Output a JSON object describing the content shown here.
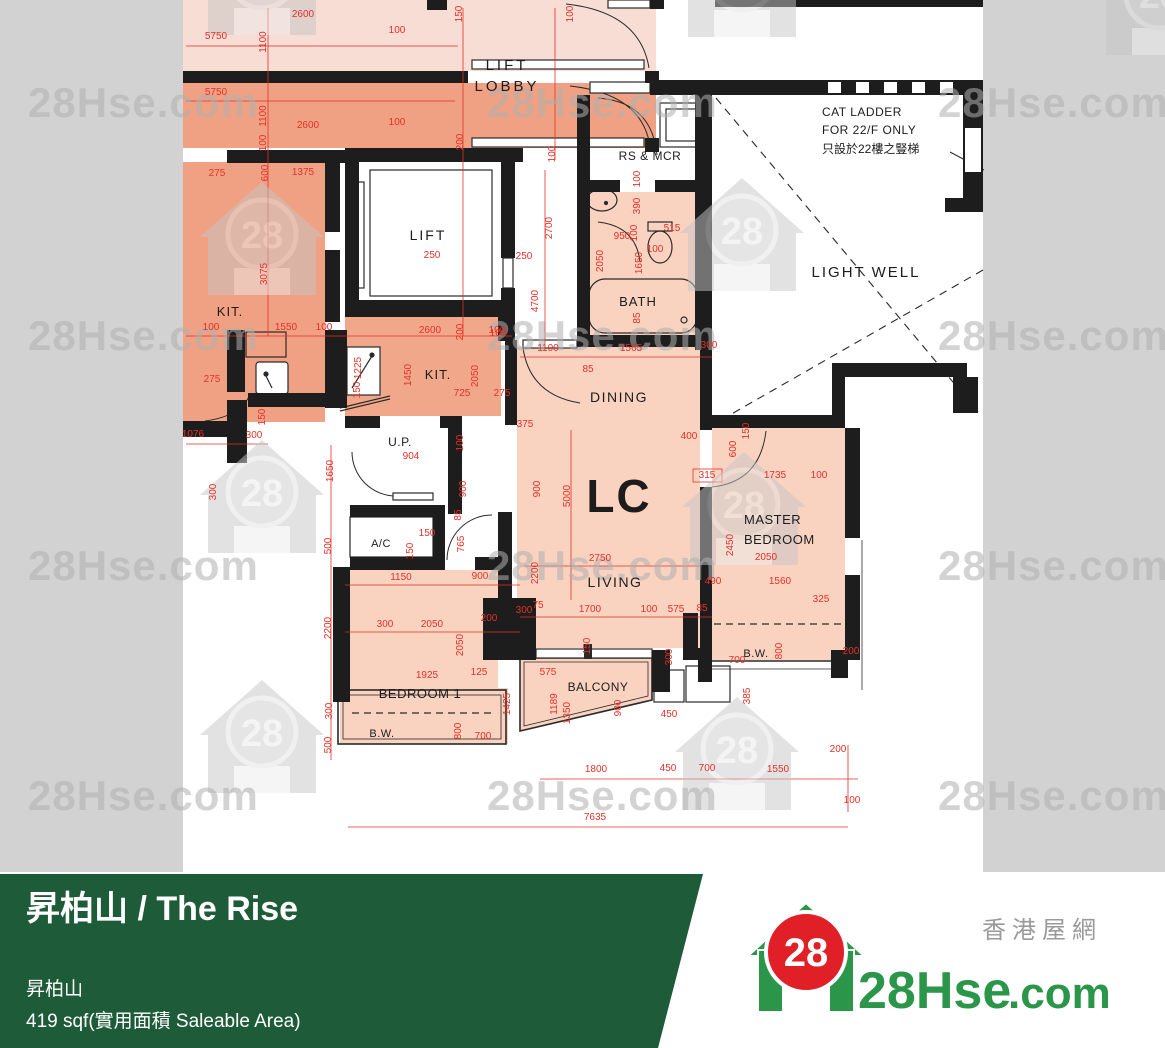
{
  "colors": {
    "page_bg": "#d2d2d2",
    "plan_bg": "#ffffff",
    "wall": "#1d1d1d",
    "dim_red": "#e23128",
    "unit_pale": "#f8ddd4",
    "unit_dark": "#f0a183",
    "kitchen": "#f1a78a",
    "unit_main": "#f9d2c0",
    "banner_green": "#1e5b38",
    "logo_green": "#2b9549",
    "logo_red": "#e01f26"
  },
  "plan": {
    "room_labels": [
      {
        "t": "LIFT",
        "x": 507,
        "y": 70,
        "s": 15,
        "a": "m",
        "ls": 3
      },
      {
        "t": "LOBBY",
        "x": 507,
        "y": 91,
        "s": 15,
        "a": "m",
        "ls": 3
      },
      {
        "t": "RS & MCR",
        "x": 650,
        "y": 160,
        "s": 12,
        "a": "m",
        "ls": 0.5
      },
      {
        "t": "CAT LADDER",
        "x": 822,
        "y": 116,
        "s": 12,
        "a": "s",
        "ls": 0.5
      },
      {
        "t": "FOR 22/F ONLY",
        "x": 822,
        "y": 134,
        "s": 12,
        "a": "s",
        "ls": 0.5
      },
      {
        "t": "只設於22樓之豎梯",
        "x": 822,
        "y": 153,
        "s": 12,
        "a": "s",
        "ls": 0
      },
      {
        "t": "LIGHT WELL",
        "x": 866,
        "y": 277,
        "s": 15,
        "a": "m",
        "ls": 2
      },
      {
        "t": "LIFT",
        "x": 428,
        "y": 240,
        "s": 14,
        "a": "m",
        "ls": 2
      },
      {
        "t": "KIT.",
        "x": 230,
        "y": 316,
        "s": 13,
        "a": "m",
        "ls": 1
      },
      {
        "t": "KIT.",
        "x": 438,
        "y": 379,
        "s": 13,
        "a": "m",
        "ls": 1
      },
      {
        "t": "BATH",
        "x": 638,
        "y": 306,
        "s": 13,
        "a": "m",
        "ls": 1
      },
      {
        "t": "DINING",
        "x": 619,
        "y": 402,
        "s": 14,
        "a": "m",
        "ls": 1.5
      },
      {
        "t": "LC",
        "x": 619,
        "y": 512,
        "s": 46,
        "a": "m",
        "ls": 2,
        "b": 1
      },
      {
        "t": "U.P.",
        "x": 400,
        "y": 446,
        "s": 12,
        "a": "m",
        "ls": 0.5
      },
      {
        "t": "A/C",
        "x": 381,
        "y": 547,
        "s": 11,
        "a": "m",
        "ls": 0.5
      },
      {
        "t": "MASTER",
        "x": 744,
        "y": 524,
        "s": 13,
        "a": "s",
        "ls": 0.5
      },
      {
        "t": "BEDROOM",
        "x": 744,
        "y": 544,
        "s": 13,
        "a": "s",
        "ls": 0.5
      },
      {
        "t": "LIVING",
        "x": 615,
        "y": 587,
        "s": 14,
        "a": "m",
        "ls": 1.5
      },
      {
        "t": "BEDROOM 1",
        "x": 420,
        "y": 698,
        "s": 13,
        "a": "m",
        "ls": 0.5
      },
      {
        "t": "BALCONY",
        "x": 598,
        "y": 691,
        "s": 12,
        "a": "m",
        "ls": 0.5
      },
      {
        "t": "B.W.",
        "x": 382,
        "y": 737,
        "s": 11,
        "a": "m",
        "ls": 0.5
      },
      {
        "t": "B.W.",
        "x": 756,
        "y": 657,
        "s": 11,
        "a": "m",
        "ls": 0.5
      }
    ],
    "dims": [
      [
        "2600",
        303,
        17,
        0
      ],
      [
        "100",
        397,
        33,
        0
      ],
      [
        "150",
        462,
        14,
        1
      ],
      [
        "100",
        573,
        14,
        1
      ],
      [
        "5750",
        216,
        39,
        0
      ],
      [
        "1100",
        266,
        42,
        1
      ],
      [
        "5750",
        216,
        95,
        0
      ],
      [
        "1100",
        266,
        116,
        1
      ],
      [
        "2600",
        308,
        128,
        0
      ],
      [
        "100",
        397,
        125,
        0
      ],
      [
        "100",
        266,
        143,
        1
      ],
      [
        "200",
        463,
        142,
        1
      ],
      [
        "100",
        555,
        154,
        1
      ],
      [
        "275",
        217,
        176,
        0
      ],
      [
        "600",
        268,
        173,
        1
      ],
      [
        "1375",
        303,
        175,
        0
      ],
      [
        "250",
        432,
        258,
        0
      ],
      [
        "250",
        524,
        259,
        0
      ],
      [
        "3075",
        267,
        274,
        1
      ],
      [
        "2700",
        552,
        228,
        1
      ],
      [
        "100",
        640,
        179,
        1
      ],
      [
        "390",
        640,
        206,
        1
      ],
      [
        "100",
        637,
        233,
        1
      ],
      [
        "515",
        672,
        231,
        0
      ],
      [
        "950",
        622,
        239,
        0
      ],
      [
        "100",
        655,
        252,
        0
      ],
      [
        "2050",
        603,
        261,
        1
      ],
      [
        "1650",
        642,
        263,
        1
      ],
      [
        "85",
        640,
        318,
        1
      ],
      [
        "100",
        211,
        330,
        0
      ],
      [
        "1550",
        286,
        330,
        0
      ],
      [
        "100",
        324,
        330,
        0
      ],
      [
        "2600",
        430,
        333,
        0
      ],
      [
        "200",
        463,
        332,
        1
      ],
      [
        "100",
        497,
        333,
        0
      ],
      [
        "275",
        212,
        382,
        0
      ],
      [
        "1225",
        361,
        368,
        1
      ],
      [
        "150",
        360,
        390,
        1
      ],
      [
        "150",
        265,
        417,
        1
      ],
      [
        "1076",
        193,
        437,
        0
      ],
      [
        "300",
        254,
        438,
        0
      ],
      [
        "300",
        216,
        492,
        1
      ],
      [
        "4700",
        538,
        301,
        1
      ],
      [
        "100",
        498,
        336,
        0
      ],
      [
        "1100",
        548,
        351,
        0
      ],
      [
        "1565",
        631,
        351,
        0
      ],
      [
        "300",
        709,
        348,
        0
      ],
      [
        "85",
        588,
        372,
        0
      ],
      [
        "1450",
        411,
        375,
        1
      ],
      [
        "2050",
        478,
        376,
        1
      ],
      [
        "725",
        462,
        396,
        0
      ],
      [
        "275",
        502,
        396,
        0
      ],
      [
        "375",
        525,
        427,
        0
      ],
      [
        "100",
        463,
        443,
        1
      ],
      [
        "904",
        411,
        459,
        0
      ],
      [
        "400",
        689,
        439,
        0
      ],
      [
        "600",
        736,
        449,
        1
      ],
      [
        "150",
        749,
        431,
        1
      ],
      [
        "315",
        707,
        478,
        0
      ],
      [
        "1735",
        775,
        478,
        0
      ],
      [
        "100",
        819,
        478,
        0
      ],
      [
        "900",
        466,
        489,
        1
      ],
      [
        "900",
        540,
        489,
        1
      ],
      [
        "5000",
        570,
        496,
        1
      ],
      [
        "85",
        461,
        515,
        1
      ],
      [
        "765",
        464,
        544,
        1
      ],
      [
        "150",
        427,
        536,
        0
      ],
      [
        "150",
        413,
        551,
        1
      ],
      [
        "2750",
        600,
        561,
        0
      ],
      [
        "2200",
        538,
        573,
        1
      ],
      [
        "2450",
        733,
        545,
        1
      ],
      [
        "2050",
        766,
        560,
        0
      ],
      [
        "1150",
        401,
        580,
        0
      ],
      [
        "900",
        480,
        579,
        0
      ],
      [
        "490",
        713,
        584,
        0
      ],
      [
        "1560",
        780,
        584,
        0
      ],
      [
        "300",
        385,
        627,
        0
      ],
      [
        "2050",
        432,
        627,
        0
      ],
      [
        "200",
        489,
        621,
        0
      ],
      [
        "2050",
        463,
        645,
        1
      ],
      [
        "300",
        524,
        613,
        0
      ],
      [
        "75",
        538,
        608,
        0
      ],
      [
        "1700",
        590,
        612,
        0
      ],
      [
        "100",
        649,
        612,
        0
      ],
      [
        "575",
        676,
        612,
        0
      ],
      [
        "85",
        702,
        611,
        0
      ],
      [
        "325",
        821,
        602,
        0
      ],
      [
        "150",
        590,
        646,
        1
      ],
      [
        "300",
        672,
        657,
        1
      ],
      [
        "700",
        737,
        663,
        0
      ],
      [
        "800",
        782,
        651,
        1
      ],
      [
        "200",
        851,
        654,
        0
      ],
      [
        "1925",
        427,
        678,
        0
      ],
      [
        "125",
        479,
        675,
        0
      ],
      [
        "575",
        548,
        675,
        0
      ],
      [
        "1425",
        510,
        704,
        1
      ],
      [
        "1189",
        557,
        704,
        1
      ],
      [
        "1350",
        570,
        713,
        1
      ],
      [
        "900",
        621,
        708,
        1
      ],
      [
        "450",
        669,
        717,
        0
      ],
      [
        "385",
        750,
        696,
        1
      ],
      [
        "800",
        461,
        731,
        1
      ],
      [
        "700",
        483,
        739,
        0
      ],
      [
        "1650",
        333,
        471,
        1
      ],
      [
        "500",
        331,
        546,
        1
      ],
      [
        "2200",
        331,
        628,
        1
      ],
      [
        "300",
        332,
        711,
        1
      ],
      [
        "500",
        331,
        745,
        1
      ],
      [
        "1800",
        596,
        772,
        0
      ],
      [
        "450",
        668,
        771,
        0
      ],
      [
        "700",
        707,
        771,
        0
      ],
      [
        "1550",
        778,
        772,
        0
      ],
      [
        "200",
        838,
        752,
        0
      ],
      [
        "100",
        852,
        803,
        0
      ],
      [
        "7635",
        595,
        820,
        0
      ]
    ]
  },
  "watermarks": {
    "text": "28Hse.com",
    "house_label": "28",
    "text_positions": [
      [
        28,
        117
      ],
      [
        487,
        117
      ],
      [
        938,
        117
      ],
      [
        28,
        350
      ],
      [
        487,
        350
      ],
      [
        938,
        350
      ],
      [
        28,
        580
      ],
      [
        487,
        580
      ],
      [
        938,
        580
      ],
      [
        28,
        810
      ],
      [
        487,
        810
      ],
      [
        938,
        810
      ]
    ],
    "house_positions": [
      [
        200,
        -78
      ],
      [
        680,
        -76
      ],
      [
        1098,
        -58
      ],
      [
        200,
        182
      ],
      [
        680,
        178
      ],
      [
        200,
        440
      ],
      [
        682,
        452
      ],
      [
        200,
        680
      ],
      [
        675,
        697
      ]
    ]
  },
  "banner": {
    "title": "昇柏山 / The Rise",
    "estate_name": "昇柏山",
    "area_line": "419 sqf(實用面積 Saleable Area)"
  },
  "logo": {
    "badge": "28",
    "site_prefix": "28Hse",
    "site_suffix": ".com",
    "tagline": "香港屋網"
  }
}
